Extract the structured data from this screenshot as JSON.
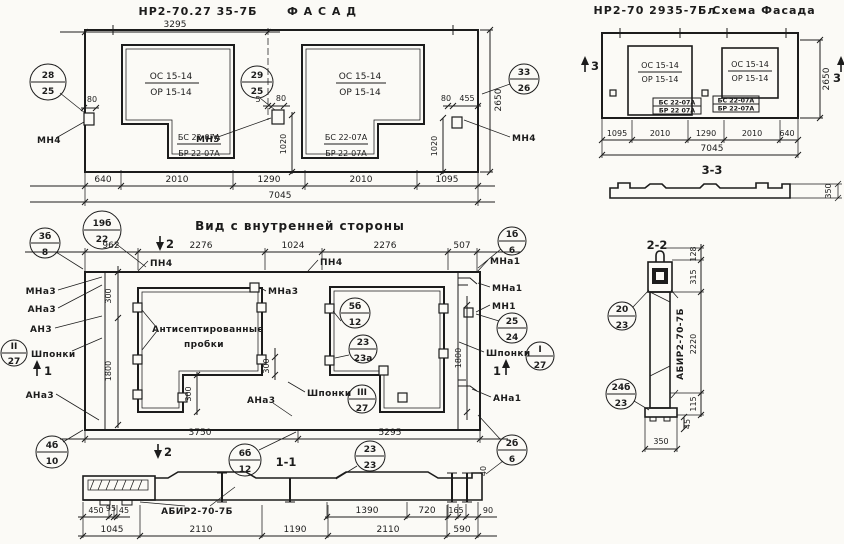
{
  "facade": {
    "code": "НР2-70.27 35-7Б",
    "name": "Ф А С А Д",
    "dim_width": "3295",
    "win_top": "ОС 15-14",
    "win_bot": "ОР 15-14",
    "sill_top": "БС 22-07А",
    "sill_bot": "БР 22-07А",
    "balloon_left": {
      "t": "28",
      "b": "25"
    },
    "balloon_mid": {
      "t": "29",
      "b": "25"
    },
    "balloon_right": {
      "t": "33",
      "b": "26"
    },
    "mn4": "МН4",
    "mn5": "МН5",
    "d80": "80",
    "d5": "5",
    "d455": "455",
    "d1020": "1020",
    "d2650": "2650",
    "dims": [
      "640",
      "2010",
      "1290",
      "2010",
      "1095"
    ],
    "total": "7045"
  },
  "schema": {
    "code": "НР2-70 2935-7Бл",
    "name": "Схема Фасада",
    "win_top": "ОС 15-14",
    "win_bot": "ОР 15-14",
    "sill_top": "БС 22-07А",
    "sill_bot": "БР 22 07А",
    "sill2_top": "БС 22-07А",
    "sill2_bot": "БР 22-07А",
    "mark": "3",
    "d2650": "2650",
    "dims": [
      "1095",
      "2010",
      "1290",
      "2010",
      "640"
    ],
    "total": "7045",
    "sec_title": "3-3",
    "d350": "350"
  },
  "view": {
    "title": "Вид с внутренней стороны",
    "dims_top": [
      "962",
      "2276",
      "1024",
      "2276",
      "507"
    ],
    "pn4": "ПН4",
    "b_19b": {
      "t": "19б",
      "b": "22"
    },
    "b_3b": {
      "t": "3б",
      "b": "8"
    },
    "b_1b": {
      "t": "1б",
      "b": "6"
    },
    "mark1": "1",
    "mark2": "2",
    "mna3": "МНа3",
    "ana3": "АНа3",
    "an3": "АН3",
    "shponki": "Шпонки",
    "b_II": {
      "t": "II",
      "b": "27"
    },
    "b_I": {
      "t": "I",
      "b": "27"
    },
    "b_III": {
      "t": "III",
      "b": "27"
    },
    "mna1": "МНа1",
    "mn1": "МН1",
    "ana1": "АНа1",
    "b_2524": {
      "t": "25",
      "b": "24"
    },
    "b_5b": {
      "t": "5б",
      "b": "12"
    },
    "b_23a": {
      "t": "23",
      "b": "23а"
    },
    "b_4b": {
      "t": "4б",
      "b": "10"
    },
    "b_6b": {
      "t": "6б",
      "b": "12"
    },
    "b_2b": {
      "t": "2б",
      "b": "6"
    },
    "note1": "Антисептированные",
    "note2": "пробки",
    "d300": "300",
    "d1800": "1800",
    "d3750": "3750",
    "d5295": "5295"
  },
  "s11": {
    "title": "1-1",
    "label": "АБИР2-70-7Б",
    "b_2323": {
      "t": "23",
      "b": "23"
    },
    "d450": "450",
    "d95": "95",
    "d45": "45",
    "d1390": "1390",
    "d720": "720",
    "d165": "165",
    "d90": "90",
    "d40": "40",
    "dims": [
      "1045",
      "2110",
      "1190",
      "2110",
      "590"
    ]
  },
  "s22": {
    "title": "2-2",
    "label": "АБИР2-70-7Б",
    "b_2023": {
      "t": "20",
      "b": "23"
    },
    "b_24b": {
      "t": "24б",
      "b": "23"
    },
    "d128": "128",
    "d315": "315",
    "d2220": "2220",
    "d115": "115",
    "d45": "45",
    "d350": "350"
  }
}
